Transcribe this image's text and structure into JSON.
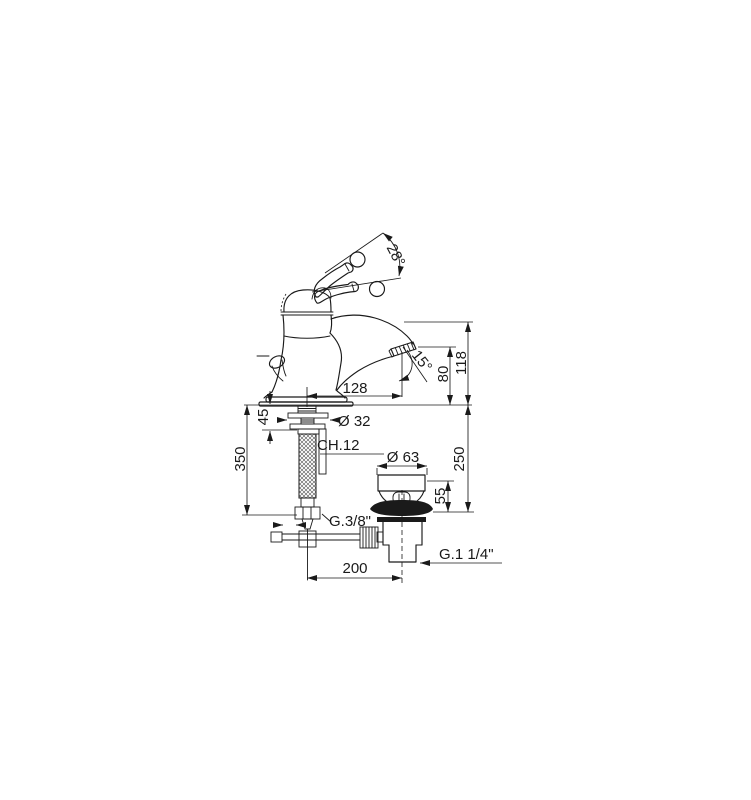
{
  "drawing": {
    "background_color": "#ffffff",
    "line_color": "#1a1a1a",
    "dims": {
      "handle_swing_angle": "28°",
      "spout_outlet_angle": "15°",
      "spout_reach": "128",
      "outlet_height": "80",
      "overall_height": "118",
      "deck_thickness": "45",
      "shank_diameter": "Ø 32",
      "wrench_size": "CH.12",
      "supply_hose_length": "350",
      "supply_thread": "G.3/8\"",
      "waste_flange_diameter": "Ø 63",
      "waste_top_height": "55",
      "waste_depth": "250",
      "waste_thread": "G.1 1/4\"",
      "waste_offset": "200"
    }
  }
}
